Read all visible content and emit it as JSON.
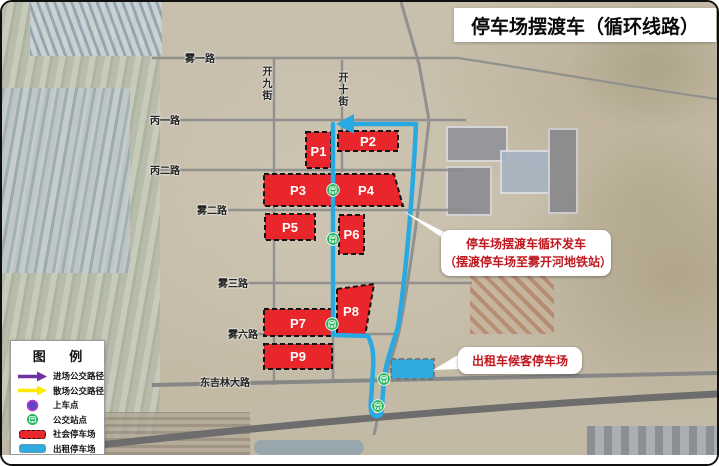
{
  "title": "停车场摆渡车（循环线路）",
  "map": {
    "roads": {
      "wuyi": "雾一路",
      "kaijiu": "开九街",
      "kaishi": "开十街",
      "bingyi": "丙一路",
      "binger": "丙二路",
      "wuer": "雾二路",
      "wusan": "雾三路",
      "wuliu": "雾六路",
      "dongjilin": "东吉林大路"
    },
    "lots": {
      "p1": "P1",
      "p2": "P2",
      "p3": "P3",
      "p4": "P4",
      "p5": "P5",
      "p6": "P6",
      "p7": "P7",
      "p8": "P8",
      "p9": "P9"
    }
  },
  "annotations": {
    "shuttle_line1": "停车场摆渡车循环发车",
    "shuttle_line2": "（摆渡停车场至雾开河地铁站）",
    "taxi": "出租车候客停车场"
  },
  "legend": {
    "title": "图  例",
    "items": [
      {
        "id": "enter-route",
        "label": "进场公交路径"
      },
      {
        "id": "exit-route",
        "label": "散场公交路径"
      },
      {
        "id": "boarding-point",
        "label": "上车点"
      },
      {
        "id": "bus-stop",
        "label": "公交站点"
      },
      {
        "id": "social-lot",
        "label": "社会停车场"
      },
      {
        "id": "taxi-lot",
        "label": "出租停车场"
      }
    ]
  },
  "colors": {
    "route_blue": "#29a9e1",
    "social_lot_red": "#e8262c",
    "taxi_lot_cyan": "#2fabdf",
    "enter_purple": "#7030a0",
    "exit_yellow": "#ffe900",
    "bus_stop_green": "#1fb457",
    "annotation_red": "#c0181f"
  }
}
